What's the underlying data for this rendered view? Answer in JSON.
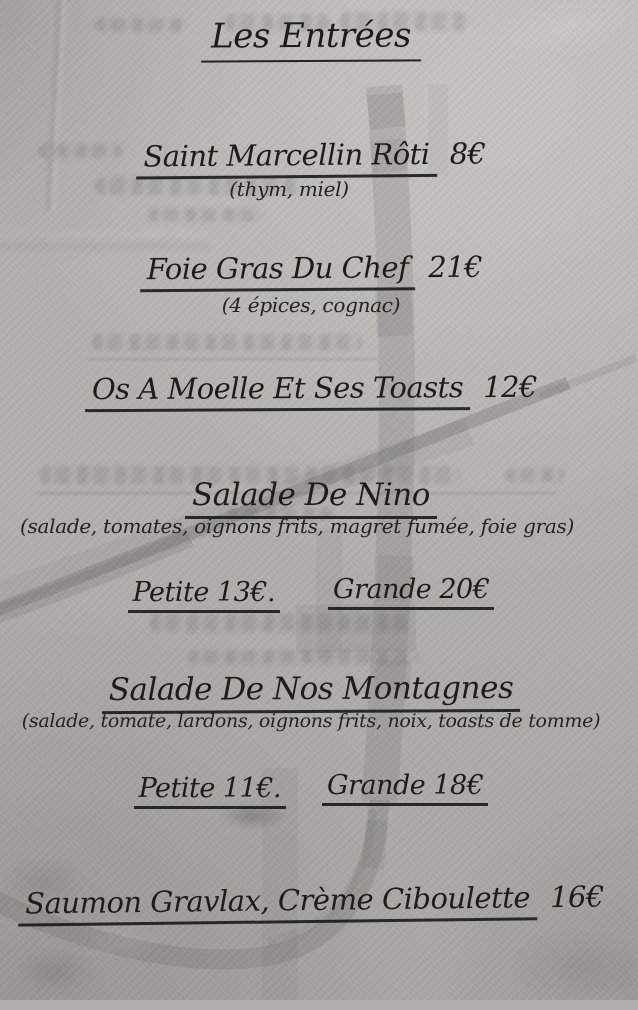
{
  "menu": {
    "title": "Les Entrées",
    "items": {
      "saint_marcellin": {
        "name": "Saint Marcellin Rôti",
        "price": "8€",
        "details": "(thym, miel)"
      },
      "foie_gras": {
        "name": "Foie Gras Du Chef",
        "price": "21€",
        "details": "(4 épices, cognac)"
      },
      "os_a_moelle": {
        "name": "Os A Moelle Et Ses Toasts",
        "price": "12€"
      },
      "salade_nino": {
        "name": "Salade De Nino",
        "details": "(salade, tomates, oignons frits, magret fumée, foie gras)",
        "petite": "Petite 13€.",
        "grande": "Grande 20€"
      },
      "salade_montagnes": {
        "name": "Salade De Nos Montagnes",
        "details": "(salade, tomate, lardons, oignons frits, noix, toasts de tomme)",
        "petite": "Petite 11€.",
        "grande": "Grande 18€"
      },
      "saumon_gravlax": {
        "name": "Saumon Gravlax, Crème Ciboulette",
        "price": "16€"
      }
    }
  },
  "style": {
    "ink_color": "#1c1c1c",
    "paper_color": "#b2b0ac",
    "watermark_color": "#6e6e6e"
  }
}
